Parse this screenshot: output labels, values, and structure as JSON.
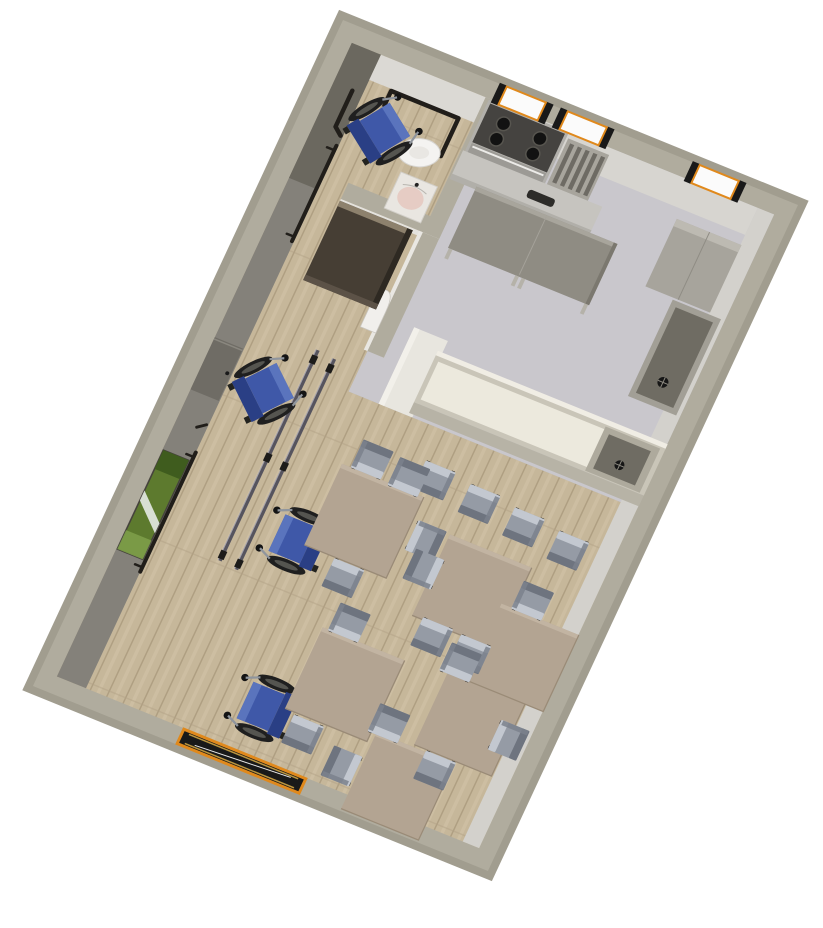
{
  "view": {
    "type": "3d-aerial-floor-plan-render",
    "background": "#ffffff"
  },
  "colors": {
    "wallTop": "#b0ac9e",
    "wallFaceDark": "#6b685f",
    "wallFaceLeft": "#84817a",
    "wallFaceLight": "#d8d6d1",
    "floorWood": "#c6b79a",
    "floorWoodLine": "#ab9b7e",
    "floorKitchen": "#c9c7cc",
    "tableTop": "#b3a492",
    "chairBody": "#959ba5",
    "chairLight": "#c3c8d0",
    "chairDark": "#6e747f",
    "wheelchairBlue": "#3f58a8",
    "wheelchairBlueDark": "#2a3f85",
    "counterCream": "#ece9dd",
    "counterFrame": "#c9c5b8",
    "islandTop": "#8f8c83",
    "sinkDark": "#6f6c63",
    "metalDark": "#454340",
    "applianceGray": "#a7a49c",
    "accentOrange": "#e0891c",
    "railBlack": "#211e1a",
    "barRail": "#56545e",
    "pictureGreen": "#5d7a2e"
  },
  "scene": {
    "rooms": [
      {
        "name": "bathroom",
        "floor": "wood-plank",
        "fixtures": [
          "toilet",
          "wash-basin",
          "grab-bars",
          "wheelchair"
        ]
      },
      {
        "name": "kitchen",
        "floor": "gray-tile",
        "fixtures": [
          "stove",
          "dish-rack",
          "base-counter",
          "refrigerator-cabinet",
          "kitchen-island",
          "sink-counter",
          "serving-counter-with-sink",
          "windows"
        ]
      },
      {
        "name": "dining-activity-room",
        "floor": "wood-plank",
        "fixtures": [
          "dining-tables",
          "chairs",
          "wheelchairs",
          "parallel-bars",
          "wall-handrails",
          "wall-picture",
          "wall-cabinet",
          "wardrobe",
          "entrance-door"
        ]
      }
    ],
    "counts": {
      "dining_tables": 6,
      "chairs": 19,
      "wheelchairs": 4,
      "windows": 3,
      "entrance_doors": 1
    },
    "furniture": [
      {
        "type": "wheelchair",
        "name": "wheelchair-bathroom",
        "x": 170,
        "y": 172,
        "rot": 35,
        "s": 1.5
      },
      {
        "type": "wheelchair",
        "name": "wheelchair-parallel-bars",
        "x": 180,
        "y": 745,
        "rot": 40,
        "s": 1.5
      },
      {
        "type": "wheelchair",
        "name": "wheelchair-table-1",
        "x": 355,
        "y": 1008,
        "rot": -90,
        "s": 1.5
      },
      {
        "type": "wheelchair",
        "name": "wheelchair-table-3",
        "x": 440,
        "y": 1345,
        "rot": -90,
        "s": 1.5
      },
      {
        "type": "table",
        "name": "dining-table-1",
        "x": 470,
        "y": 920,
        "rot": 0,
        "s": 1.8
      },
      {
        "type": "table",
        "name": "dining-table-2",
        "x": 730,
        "y": 970,
        "rot": 0,
        "s": 1.8
      },
      {
        "type": "table",
        "name": "dining-table-3",
        "x": 575,
        "y": 1240,
        "rot": 0,
        "s": 1.8
      },
      {
        "type": "table",
        "name": "dining-table-4",
        "x": 840,
        "y": 1215,
        "rot": 0,
        "s": 1.7
      },
      {
        "type": "table",
        "name": "dining-table-5",
        "x": 880,
        "y": 1055,
        "rot": 0,
        "s": 1.7
      },
      {
        "type": "table",
        "name": "dining-table-6",
        "x": 760,
        "y": 1390,
        "rot": 0,
        "s": 1.7
      },
      {
        "type": "chair",
        "name": "counter-chair-1",
        "x": 565,
        "y": 790,
        "rot": 0,
        "s": 1
      },
      {
        "type": "chair",
        "name": "counter-chair-2",
        "x": 668,
        "y": 800,
        "rot": 0,
        "s": 1
      },
      {
        "type": "chair",
        "name": "counter-chair-3",
        "x": 770,
        "y": 810,
        "rot": 0,
        "s": 1
      },
      {
        "type": "chair",
        "name": "counter-chair-4",
        "x": 872,
        "y": 820,
        "rot": 0,
        "s": 1
      },
      {
        "type": "chair",
        "name": "chair-t1-a",
        "x": 432,
        "y": 800,
        "rot": 180,
        "s": 1
      },
      {
        "type": "chair",
        "name": "chair-t1-b",
        "x": 515,
        "y": 805,
        "rot": 180,
        "s": 1
      },
      {
        "type": "chair",
        "name": "chair-t1-c",
        "x": 600,
        "y": 910,
        "rot": 270,
        "s": 1
      },
      {
        "type": "chair",
        "name": "chair-t1-d",
        "x": 480,
        "y": 1042,
        "rot": 0,
        "s": 1
      },
      {
        "type": "chair",
        "name": "chair-t2-a",
        "x": 622,
        "y": 965,
        "rot": 90,
        "s": 1
      },
      {
        "type": "chair",
        "name": "chair-t2-b",
        "x": 695,
        "y": 1085,
        "rot": 0,
        "s": 1
      },
      {
        "type": "chair",
        "name": "chair-t2-c",
        "x": 780,
        "y": 1088,
        "rot": 0,
        "s": 1
      },
      {
        "type": "chair",
        "name": "chair-t3-a",
        "x": 530,
        "y": 1122,
        "rot": 180,
        "s": 1
      },
      {
        "type": "chair",
        "name": "chair-t3-b",
        "x": 540,
        "y": 1365,
        "rot": 0,
        "s": 1
      },
      {
        "type": "chair",
        "name": "chair-t4-a",
        "x": 770,
        "y": 1112,
        "rot": 180,
        "s": 1
      },
      {
        "type": "chair",
        "name": "chair-t4-b",
        "x": 925,
        "y": 1220,
        "rot": 270,
        "s": 1
      },
      {
        "type": "chair",
        "name": "chair-t4-c",
        "x": 815,
        "y": 1332,
        "rot": 0,
        "s": 1
      },
      {
        "type": "chair",
        "name": "chair-t5-a",
        "x": 850,
        "y": 942,
        "rot": 180,
        "s": 1
      },
      {
        "type": "chair",
        "name": "chair-t6-a",
        "x": 690,
        "y": 1280,
        "rot": 180,
        "s": 1
      },
      {
        "type": "chair",
        "name": "chair-t6-b",
        "x": 640,
        "y": 1395,
        "rot": 90,
        "s": 1
      }
    ]
  }
}
